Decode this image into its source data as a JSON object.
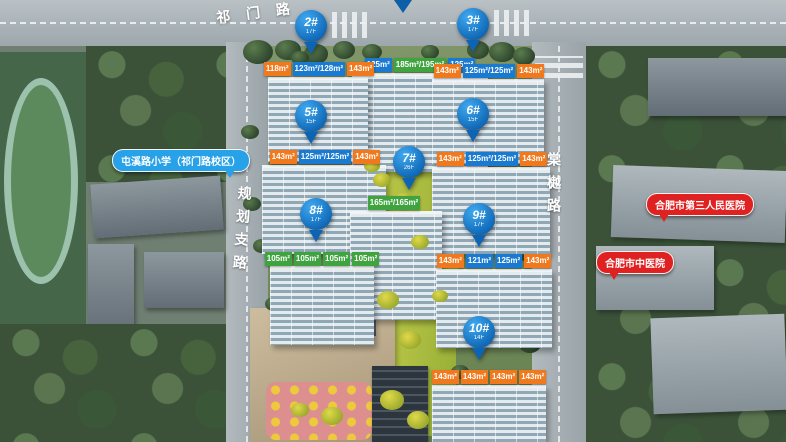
{
  "roads": {
    "top": "祁门路",
    "left": "规划支路",
    "right": "棠樾路"
  },
  "pois": {
    "school": "屯溪路小学（祁门路校区）",
    "hospital_1": "合肥市第三人民医院",
    "hospital_2": "合肥市中医院"
  },
  "colors": {
    "pin_blue": "#0d64b2",
    "unit_orange": "#f0791e",
    "unit_blue": "#1a7ad0",
    "unit_green": "#3fa33f",
    "school_bubble": "#27a2e8",
    "hospital_bubble": "#e02121"
  },
  "buildings": [
    {
      "id": "",
      "floors": "",
      "units": [
        {
          "t": "125m²",
          "c": "blue"
        },
        {
          "t": "185m²/195m²",
          "c": "green"
        },
        {
          "t": "125m²",
          "c": "blue"
        }
      ],
      "label": {
        "x": 352,
        "y": 58,
        "w": 136
      },
      "facade": {
        "x": 352,
        "y": 73,
        "w": 136,
        "h": 96
      },
      "pin": null
    },
    {
      "id": "2#",
      "floors": "17F",
      "units": [
        {
          "t": "118m²",
          "c": "orange"
        },
        {
          "t": "123m²/128m²",
          "c": "blue"
        },
        {
          "t": "143m²",
          "c": "orange"
        }
      ],
      "label": {
        "x": 268,
        "y": 62,
        "w": 102
      },
      "facade": {
        "x": 268,
        "y": 77,
        "w": 100,
        "h": 82
      },
      "pin": {
        "x": 295,
        "y": 10
      }
    },
    {
      "id": "3#",
      "floors": "17F",
      "units": [
        {
          "t": "143m²",
          "c": "orange"
        },
        {
          "t": "125m²/125m²",
          "c": "blue"
        },
        {
          "t": "143m²",
          "c": "orange"
        }
      ],
      "label": {
        "x": 432,
        "y": 64,
        "w": 114
      },
      "facade": {
        "x": 432,
        "y": 79,
        "w": 112,
        "h": 82
      },
      "pin": {
        "x": 457,
        "y": 8
      }
    },
    {
      "id": "5#",
      "floors": "15F",
      "units": [
        {
          "t": "143m²",
          "c": "orange"
        },
        {
          "t": "125m²/125m²",
          "c": "blue"
        },
        {
          "t": "143m²",
          "c": "orange"
        }
      ],
      "label": {
        "x": 262,
        "y": 150,
        "w": 126
      },
      "facade": {
        "x": 262,
        "y": 165,
        "w": 124,
        "h": 86
      },
      "pin": {
        "x": 295,
        "y": 100
      }
    },
    {
      "id": "6#",
      "floors": "15F",
      "units": [
        {
          "t": "143m²",
          "c": "orange"
        },
        {
          "t": "125m²/125m²",
          "c": "blue"
        },
        {
          "t": "143m²",
          "c": "orange"
        }
      ],
      "label": {
        "x": 432,
        "y": 152,
        "w": 120
      },
      "facade": {
        "x": 432,
        "y": 167,
        "w": 118,
        "h": 84
      },
      "pin": {
        "x": 457,
        "y": 98
      }
    },
    {
      "id": "7#",
      "floors": "26F",
      "units": [
        {
          "t": "165m²/165m²",
          "c": "green"
        }
      ],
      "label": {
        "x": 348,
        "y": 196,
        "w": 92
      },
      "facade": {
        "x": 350,
        "y": 211,
        "w": 92,
        "h": 106
      },
      "pin": {
        "x": 393,
        "y": 146
      }
    },
    {
      "id": "8#",
      "floors": "17F",
      "units": [
        {
          "t": "105m²",
          "c": "green"
        },
        {
          "t": "105m²",
          "c": "green"
        },
        {
          "t": "105m²",
          "c": "green"
        },
        {
          "t": "105m²",
          "c": "green"
        }
      ],
      "label": {
        "x": 266,
        "y": 252,
        "w": 112
      },
      "facade": {
        "x": 270,
        "y": 266,
        "w": 104,
        "h": 76
      },
      "pin": {
        "x": 300,
        "y": 198
      }
    },
    {
      "id": "9#",
      "floors": "17F",
      "units": [
        {
          "t": "143m²",
          "c": "orange"
        },
        {
          "t": "121m²",
          "c": "blue"
        },
        {
          "t": "125m²",
          "c": "blue"
        },
        {
          "t": "143m²",
          "c": "orange"
        }
      ],
      "label": {
        "x": 432,
        "y": 254,
        "w": 124
      },
      "facade": {
        "x": 436,
        "y": 269,
        "w": 116,
        "h": 76
      },
      "pin": {
        "x": 463,
        "y": 203
      }
    },
    {
      "id": "10#",
      "floors": "14F",
      "units": [
        {
          "t": "143m²",
          "c": "orange"
        },
        {
          "t": "143m²",
          "c": "orange"
        },
        {
          "t": "143m²",
          "c": "orange"
        },
        {
          "t": "143m²",
          "c": "orange"
        }
      ],
      "label": {
        "x": 428,
        "y": 370,
        "w": 122
      },
      "facade": {
        "x": 432,
        "y": 385,
        "w": 114,
        "h": 57
      },
      "pin": {
        "x": 463,
        "y": 316
      }
    }
  ]
}
